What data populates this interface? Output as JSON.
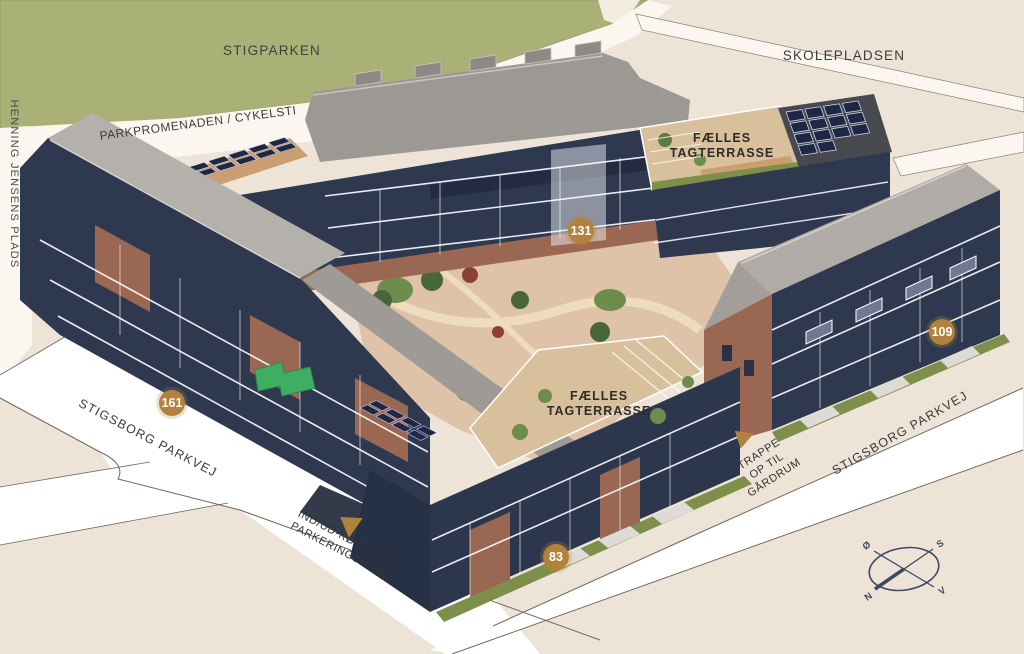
{
  "labels": {
    "park": "STIGPARKEN",
    "school_plaza": "SKOLEPLADSEN",
    "plads": "HENNING JENSENS PLADS",
    "promenade": "PARKPROMENADEN / CYKELSTI",
    "street_sw": "STIGSBORG PARKVEJ",
    "street_se": "STIGSBORG PARKVEJ"
  },
  "annotations": {
    "roof_terrace_ne": {
      "line1": "FÆLLES",
      "line2": "TAGTERRASSE"
    },
    "roof_terrace_s": {
      "line1": "FÆLLES",
      "line2": "TAGTERRASSE"
    },
    "parking_entry": {
      "line1": "IND/UD-KØRSEL TIL",
      "line2": "PARKERINGSETAGE"
    },
    "courtyard_stairs": {
      "line1": "TRAPPE",
      "line2": "OP TIL",
      "line3": "GÅRDRUM"
    }
  },
  "markers": {
    "m131": "131",
    "m161": "161",
    "m109": "109",
    "m83": "83"
  },
  "compass": {
    "n": "N",
    "s": "S",
    "e": "Ø",
    "w": "V"
  },
  "colors": {
    "background": "#ede4d7",
    "park_green": "#a9b176",
    "road_white": "#ffffff",
    "marker_gold": "#b2823c",
    "facade_navy": "#2e3950",
    "brick": "#9a6753",
    "roof_gray": "#a19c97",
    "terrace_tan": "#d9c09c",
    "courtyard_tan": "#dfc3a8",
    "hedge_olive": "#7d8f4a",
    "solar_navy": "#1e2746",
    "highlight_green": "#3fae62",
    "compass_navy": "#3d4a66",
    "label_dark": "#3b3b3b"
  }
}
